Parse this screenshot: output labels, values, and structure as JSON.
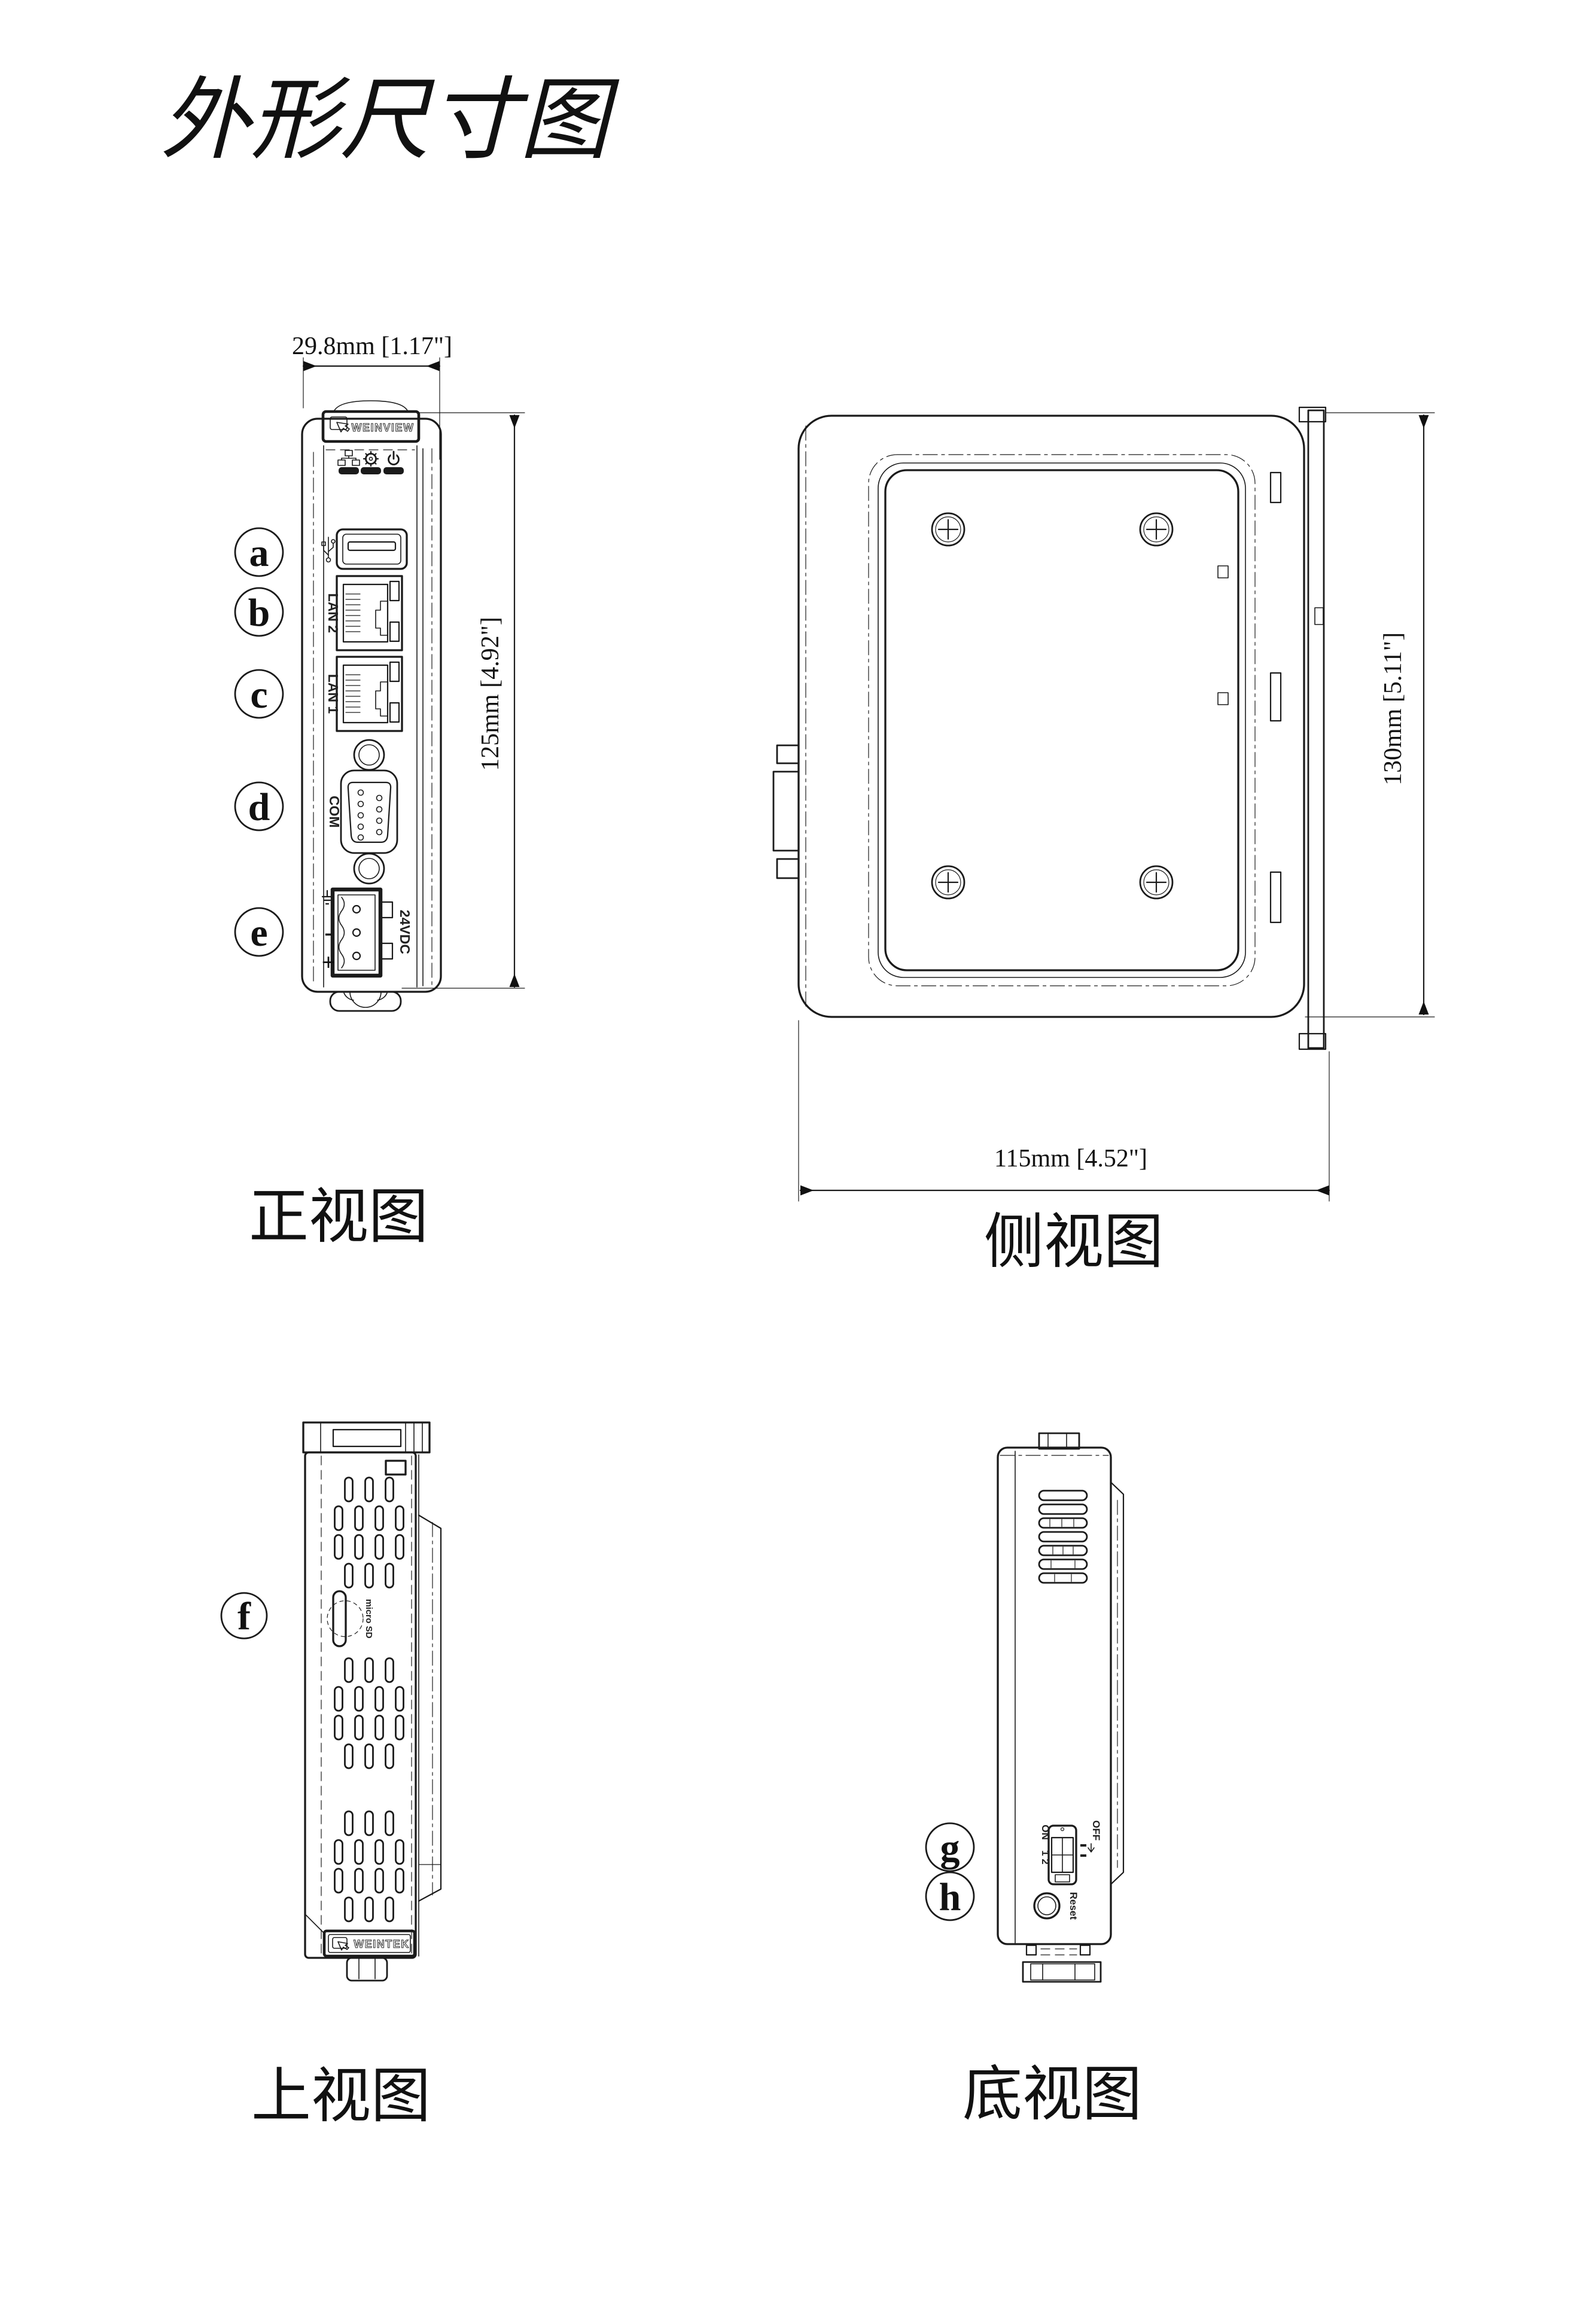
{
  "title": "外形尺寸图",
  "views": {
    "front": "正视图",
    "side": "侧视图",
    "top": "上视图",
    "bottom": "底视图"
  },
  "dims": {
    "front_width": "29.8mm [1.17\"]",
    "front_height": "125mm [4.92\"]",
    "side_height": "130mm [5.11\"]",
    "side_width": "115mm [4.52\"]"
  },
  "callouts": {
    "a": "a",
    "b": "b",
    "c": "c",
    "d": "d",
    "e": "e",
    "f": "f",
    "g": "g",
    "h": "h"
  },
  "front": {
    "brand": "WEINVIEW",
    "lan2": "LAN 2",
    "lan1": "LAN 1",
    "com": "COM",
    "power": "24VDC",
    "plus": "+",
    "minus": "-"
  },
  "top": {
    "brand": "WEINTEK",
    "sd": "micro SD"
  },
  "bottom": {
    "on": "ON",
    "channels": "1 2",
    "off": "OFF",
    "reset": "Reset"
  },
  "icons": {
    "usb": "usb-icon",
    "ethernet": "ethernet-icon",
    "settings": "gear-icon",
    "power": "power-icon",
    "touch": "touch-hand-icon",
    "ground": "ground-icon",
    "down_arrow": "down-arrow-icon",
    "sd_card": "sd-card-icon"
  }
}
